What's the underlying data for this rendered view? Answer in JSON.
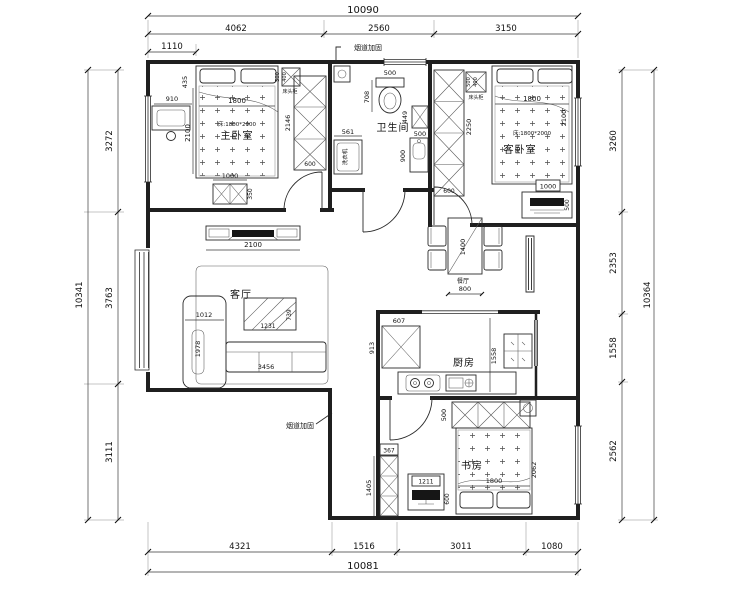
{
  "page": {
    "background": "#ffffff",
    "line_color": "#1f1f1f"
  },
  "dims": {
    "top": {
      "total": "10090",
      "segs": [
        "4062",
        "2560",
        "3150"
      ],
      "sub": "1110"
    },
    "left": {
      "total": "10341",
      "segs": [
        "3272",
        "3763",
        "3111"
      ]
    },
    "right": {
      "total": "10364",
      "segs": [
        "3260",
        "2353",
        "1558",
        "2562"
      ]
    },
    "bottom": {
      "total": "10081",
      "segs": [
        "4321",
        "1516",
        "3011",
        "1080"
      ]
    }
  },
  "annotations": {
    "flue_top": "烟道加固",
    "flue_bottom": "烟道加固"
  },
  "rooms": {
    "master": {
      "name": "主卧室",
      "bed_spec": "床:1800*2000",
      "bed_w": "1800",
      "bed_d": "2100",
      "side": "435",
      "dresser": "910",
      "ns_label": "床头柜",
      "ns_w": "500",
      "ns_d": "400",
      "wardrobe_h": "2146",
      "wardrobe_w": "600",
      "cab_w": "1000",
      "cab_d": "350"
    },
    "bath": {
      "name": "卫生间",
      "toilet_w": "500",
      "toilet_d": "708",
      "washer_w": "561",
      "washer": "洗衣机",
      "cab_d": "449",
      "cab_w": "500",
      "vanity": "900"
    },
    "guest": {
      "name": "客卧室",
      "bed_spec": "床:1800*2000",
      "bed_w": "1800",
      "bed_d": "2100",
      "ns_label": "床头柜",
      "ns_w": "500",
      "ns_d": "400",
      "wardrobe_h": "2250",
      "wardrobe_w": "600",
      "tv_w": "1000",
      "tv_d": "500"
    },
    "living": {
      "name": "客厅",
      "tv_wall": "2100",
      "table_w": "1231",
      "table_d": "739",
      "sofa": "3456",
      "chaise_w": "1012",
      "chaise_d": "1978"
    },
    "dining": {
      "name": "餐厅",
      "table_l": "1400",
      "table_w": "800"
    },
    "kitchen": {
      "name": "厨房",
      "counter": "607",
      "counter_d": "913",
      "depth": "1558"
    },
    "study": {
      "name": "书房",
      "bed_w": "1800",
      "bed_d": "2062",
      "desk_w": "1211",
      "desk_d": "600",
      "wardrobe": "500",
      "cab_w": "367",
      "cab_h": "1405"
    }
  }
}
